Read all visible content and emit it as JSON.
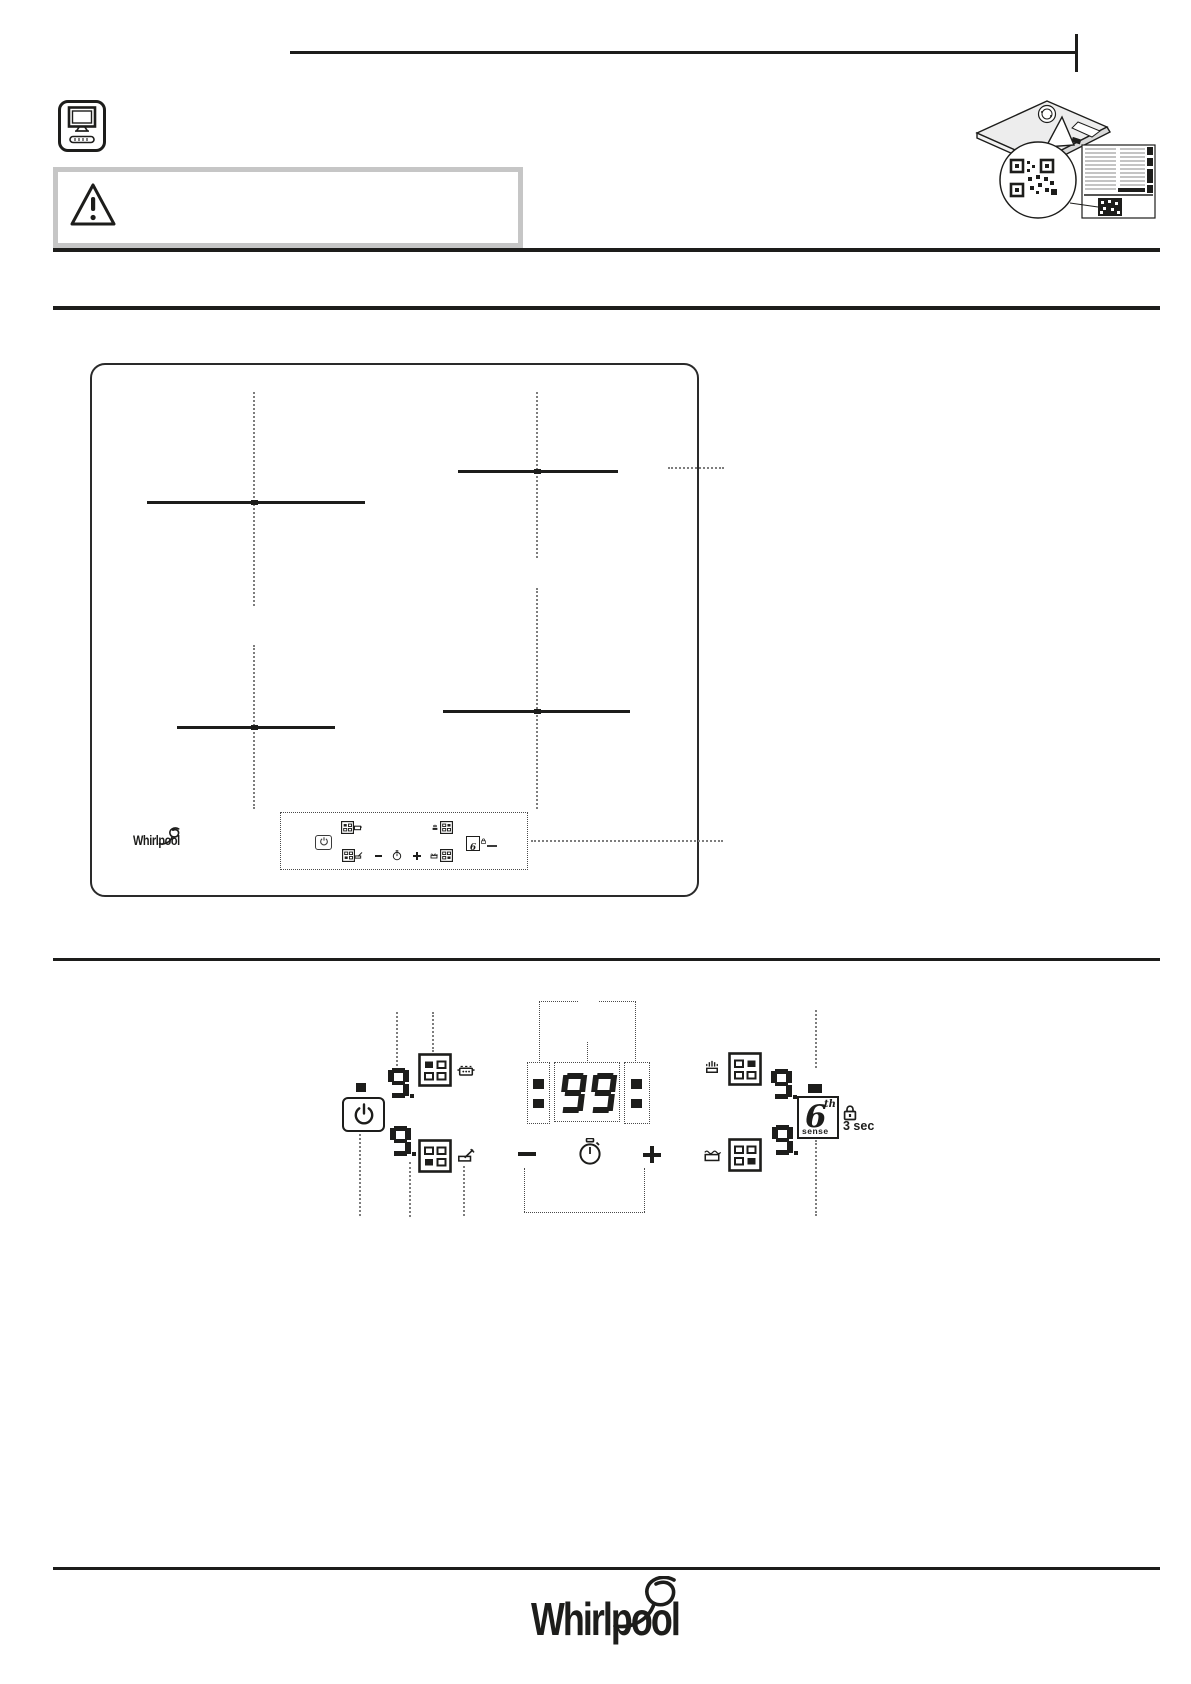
{
  "page": {
    "background": "#ffffff",
    "ink": "#1d1d1b",
    "warning_border": "#c6c6c6",
    "dotted_line_color": "#7d7d7d"
  },
  "brand": {
    "name": "Whirlpool"
  },
  "sixth_sense": {
    "digit": "6",
    "sup": "th",
    "word": "sense"
  },
  "lock": {
    "label": "3 sec"
  },
  "displays": {
    "zone1": "9",
    "zone2": "9",
    "zone3": "9",
    "zone4": "9",
    "timer": "99"
  }
}
